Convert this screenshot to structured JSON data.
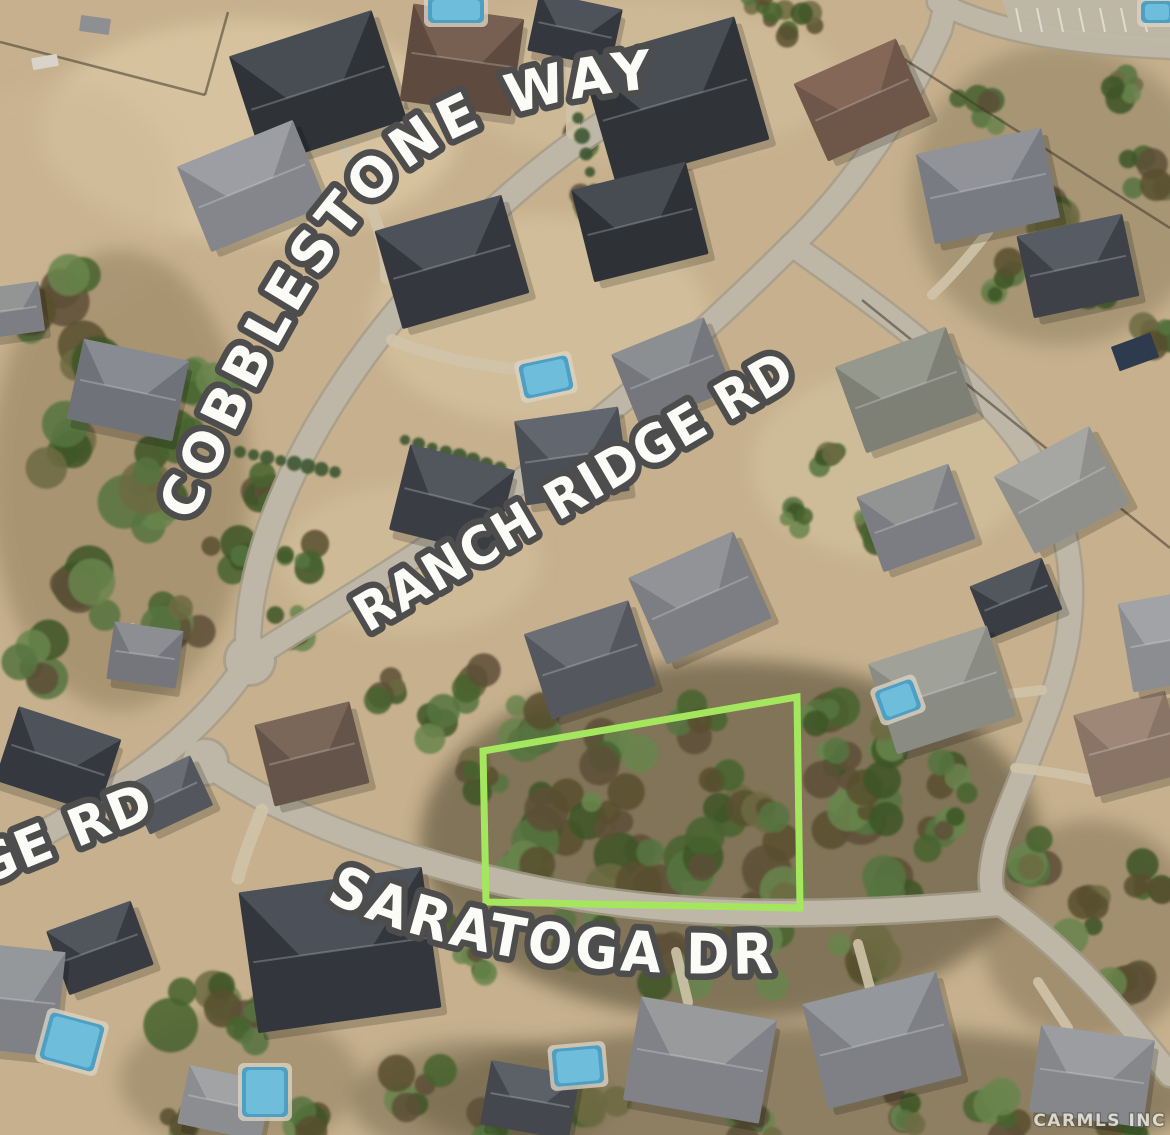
{
  "labels": {
    "cobblestone": "COBBLESTONE WAY",
    "ranch_ridge": "RANCH RIDGE RD",
    "ridge_partial": "GE RD",
    "saratoga": "SARATOGA DR",
    "watermark": "CARMLS INC"
  },
  "map": {
    "type": "aerial-satellite-lot-highlight",
    "lot_outline": {
      "points": "483,751 797,697 800,908 486,902",
      "color": "#a4e75e",
      "stroke_width": 7
    }
  },
  "palette": {
    "dirt_base": "#c6b08d",
    "road": "#beb7a7",
    "road_casing": "#a59d8b",
    "driveway": "#cfc3a8",
    "label_fill": "#fbfbf8",
    "label_outline": "#4d4d4d",
    "pool": "#4d9fc4",
    "pool_inner": "#74c2de",
    "hedge": "#3e5630",
    "fence": "#43392c",
    "tree_colors": [
      "#46632f",
      "#567441",
      "#3c5527",
      "#69854d",
      "#6d6a42",
      "#59502f",
      "#5d4f38"
    ]
  },
  "scene": {
    "patches": [
      [
        250,
        130,
        210,
        110,
        "#dcc9a4",
        0.75
      ],
      [
        540,
        320,
        170,
        105,
        "#d9c6a2",
        0.6
      ],
      [
        890,
        465,
        140,
        95,
        "#d6c5a2",
        0.55
      ],
      [
        410,
        560,
        130,
        75,
        "#d8c5a1",
        0.5
      ],
      [
        640,
        80,
        200,
        80,
        "#d5c2a0",
        0.5
      ],
      [
        60,
        200,
        120,
        120,
        "#cdb795",
        0.5
      ],
      [
        120,
        480,
        130,
        230,
        "#8d7a58",
        0.5
      ],
      [
        730,
        840,
        310,
        180,
        "#5d553c",
        0.65
      ],
      [
        800,
        1100,
        390,
        75,
        "#6a6146",
        0.6
      ],
      [
        1060,
        195,
        150,
        150,
        "#8a7c5c",
        0.5
      ],
      [
        480,
        1100,
        130,
        60,
        "#6f6549",
        0.5
      ],
      [
        1090,
        930,
        110,
        110,
        "#77684c",
        0.45
      ],
      [
        240,
        1080,
        120,
        70,
        "#7c6d50",
        0.4
      ]
    ],
    "roads": [
      {
        "d": "M 655,95 C 560,140 440,250 362,358 C 292,455 250,555 248,640 L 250,660",
        "w": 24
      },
      {
        "d": "M 250,660 C 210,720 150,780 -10,862",
        "w": 24
      },
      {
        "d": "M 205,762 C 290,822 420,868 565,895 C 690,917 820,918 1000,903",
        "w": 24
      },
      {
        "d": "M 1000,903 C 1065,948 1115,1005 1170,1075",
        "w": 22
      },
      {
        "d": "M 252,658 C 340,602 440,545 535,470 C 635,395 725,312 792,245",
        "w": 22
      },
      {
        "d": "M 792,245 C 845,195 900,120 940,30 L 948,-5",
        "w": 22
      },
      {
        "d": "M 792,245 C 870,300 960,365 1015,435 C 1065,500 1078,565 1068,635 C 1058,705 1012,790 996,845 C 989,875 988,893 1000,903",
        "w": 22
      },
      {
        "d": "M 938,2 C 990,30 1065,44 1175,48",
        "w": 20
      }
    ],
    "bulbs": [
      [
        250,
        660,
        24
      ],
      [
        205,
        762,
        22
      ]
    ],
    "parking": {
      "apron": "M 1002,0 L 1170,0 L 1170,42 C 1100,40 1040,30 1008,18 Z",
      "x0": 1016,
      "y0": 8,
      "count": 7,
      "dx": 21,
      "len": 24,
      "tilt": 5
    },
    "driveways": [
      {
        "d": "M 345,150 C 372,205 388,245 386,278",
        "w": 12
      },
      {
        "d": "M 573,0 L 573,132",
        "w": 14
      },
      {
        "d": "M 392,340 C 440,360 495,368 548,372",
        "w": 12
      },
      {
        "d": "M 262,810 C 250,840 242,862 238,878",
        "w": 13
      },
      {
        "d": "M 688,1002 L 676,952",
        "w": 10
      },
      {
        "d": "M 870,988 L 858,944",
        "w": 10
      },
      {
        "d": "M 1068,1028 L 1038,982",
        "w": 10
      },
      {
        "d": "M 132,628 L 152,664",
        "w": 10
      },
      {
        "d": "M 95,788 L 138,802",
        "w": 10
      },
      {
        "d": "M 988,232 C 968,258 950,278 932,295",
        "w": 10
      },
      {
        "d": "M 1000,695 L 1042,690",
        "w": 10
      },
      {
        "d": "M 1100,782 C 1070,775 1040,770 1015,768",
        "w": 10
      }
    ],
    "fences": [
      "M 893,52 L 1170,228",
      "M 862,300 L 1170,548",
      "M 0,42 L 205,95",
      "M 205,95 L 228,12"
    ],
    "hedges": [
      {
        "x1": 240,
        "y1": 452,
        "x2": 335,
        "y2": 472,
        "n": 8
      },
      {
        "x1": 405,
        "y1": 440,
        "x2": 500,
        "y2": 468,
        "n": 8
      },
      {
        "x1": 578,
        "y1": 118,
        "x2": 594,
        "y2": 190,
        "n": 5
      }
    ],
    "houses": [
      [
        318,
        88,
        150,
        115,
        -18,
        "#2f3338",
        "#4b5058"
      ],
      [
        575,
        30,
        85,
        60,
        12,
        "#34383e",
        "#51565e"
      ],
      [
        462,
        60,
        112,
        98,
        8,
        "#5e4a3e",
        "#7a6253"
      ],
      [
        675,
        100,
        160,
        128,
        -16,
        "#303439",
        "#4c5159"
      ],
      [
        862,
        100,
        112,
        85,
        -24,
        "#6e5648",
        "#87695a"
      ],
      [
        988,
        186,
        128,
        92,
        -12,
        "#787b81",
        "#94969b"
      ],
      [
        1078,
        266,
        108,
        84,
        -12,
        "#3e4248",
        "#5a5f67"
      ],
      [
        252,
        186,
        125,
        92,
        -22,
        "#84868b",
        "#9fa1a5"
      ],
      [
        128,
        390,
        108,
        82,
        12,
        "#6f7278",
        "#8b8e93"
      ],
      [
        12,
        310,
        60,
        50,
        -8,
        "#7c7e83",
        "#969896"
      ],
      [
        452,
        262,
        132,
        102,
        -16,
        "#34383e",
        "#50555d"
      ],
      [
        640,
        222,
        118,
        95,
        -14,
        "#2e3237",
        "#4a4f57"
      ],
      [
        672,
        372,
        100,
        78,
        -22,
        "#75777d",
        "#8f9194"
      ],
      [
        906,
        390,
        118,
        92,
        -20,
        "#7e8076",
        "#989a90"
      ],
      [
        1062,
        490,
        108,
        88,
        -28,
        "#8f908c",
        "#a8a9a4"
      ],
      [
        916,
        518,
        98,
        80,
        -20,
        "#7b7d82",
        "#959796"
      ],
      [
        1016,
        598,
        78,
        56,
        -22,
        "#3a3e44",
        "#555a62"
      ],
      [
        572,
        456,
        105,
        85,
        -8,
        "#4a4e55",
        "#656a72"
      ],
      [
        452,
        500,
        108,
        88,
        14,
        "#3a3e44",
        "#555a62"
      ],
      [
        590,
        660,
        110,
        90,
        -18,
        "#54575d",
        "#6e7178"
      ],
      [
        700,
        598,
        115,
        95,
        -24,
        "#7c7e83",
        "#949699"
      ],
      [
        145,
        655,
        70,
        58,
        8,
        "#74767c",
        "#8f9193"
      ],
      [
        58,
        760,
        108,
        78,
        18,
        "#35393f",
        "#51565e"
      ],
      [
        170,
        795,
        70,
        55,
        -25,
        "#53565c",
        "#6d7077"
      ],
      [
        312,
        754,
        98,
        84,
        -14,
        "#64544a",
        "#7d695c"
      ],
      [
        340,
        950,
        185,
        142,
        -8,
        "#33373d",
        "#4f545c"
      ],
      [
        100,
        948,
        90,
        68,
        -20,
        "#383c42",
        "#54595f"
      ],
      [
        18,
        1000,
        85,
        105,
        6,
        "#7f8186",
        "#989a9d"
      ],
      [
        225,
        1103,
        85,
        60,
        12,
        "#8b8d90",
        "#a3a5a7"
      ],
      [
        530,
        1100,
        90,
        65,
        10,
        "#44484e",
        "#5f646c"
      ],
      [
        700,
        1060,
        138,
        105,
        10,
        "#808287",
        "#9a9c9f"
      ],
      [
        882,
        1040,
        138,
        108,
        -14,
        "#7e8085",
        "#97999d"
      ],
      [
        1092,
        1076,
        115,
        88,
        8,
        "#85878b",
        "#9da0a2"
      ],
      [
        942,
        690,
        125,
        95,
        -18,
        "#8a8c84",
        "#a2a49c"
      ],
      [
        1130,
        744,
        95,
        85,
        -15,
        "#8a7465",
        "#a08a78"
      ],
      [
        1160,
        642,
        70,
        90,
        -10,
        "#8b8d91",
        "#a3a5a8"
      ]
    ],
    "pools": [
      [
        456,
        10,
        56,
        26,
        0
      ],
      [
        546,
        377,
        50,
        35,
        -12
      ],
      [
        898,
        700,
        40,
        32,
        -20
      ],
      [
        72,
        1042,
        56,
        48,
        15
      ],
      [
        265,
        1092,
        46,
        50,
        0
      ],
      [
        1157,
        12,
        32,
        22,
        0
      ],
      [
        578,
        1066,
        50,
        38,
        -5
      ]
    ],
    "trees": [
      [
        55,
        300,
        38
      ],
      [
        105,
        375,
        42
      ],
      [
        68,
        448,
        38
      ],
      [
        140,
        515,
        42
      ],
      [
        92,
        588,
        38
      ],
      [
        178,
        618,
        32
      ],
      [
        40,
        658,
        32
      ],
      [
        228,
        558,
        28
      ],
      [
        168,
        448,
        32
      ],
      [
        208,
        378,
        28
      ],
      [
        255,
        490,
        24
      ],
      [
        300,
        560,
        22
      ],
      [
        290,
        625,
        20
      ],
      [
        582,
        148,
        20
      ],
      [
        590,
        200,
        16
      ],
      [
        800,
        25,
        22
      ],
      [
        760,
        8,
        18
      ],
      [
        975,
        115,
        28
      ],
      [
        1038,
        218,
        32
      ],
      [
        1098,
        278,
        28
      ],
      [
        1148,
        178,
        28
      ],
      [
        1000,
        278,
        22
      ],
      [
        1128,
        88,
        22
      ],
      [
        958,
        195,
        24
      ],
      [
        1160,
        330,
        24
      ],
      [
        836,
        458,
        22
      ],
      [
        872,
        532,
        22
      ],
      [
        800,
        520,
        18
      ],
      [
        470,
        688,
        26
      ],
      [
        522,
        728,
        30
      ],
      [
        482,
        778,
        26
      ],
      [
        560,
        818,
        36
      ],
      [
        638,
        868,
        40
      ],
      [
        718,
        798,
        36
      ],
      [
        778,
        878,
        40
      ],
      [
        848,
        818,
        36
      ],
      [
        898,
        878,
        32
      ],
      [
        678,
        958,
        36
      ],
      [
        582,
        938,
        32
      ],
      [
        758,
        958,
        36
      ],
      [
        858,
        948,
        32
      ],
      [
        938,
        828,
        28
      ],
      [
        618,
        758,
        30
      ],
      [
        698,
        718,
        26
      ],
      [
        818,
        718,
        30
      ],
      [
        898,
        738,
        26
      ],
      [
        958,
        778,
        26
      ],
      [
        528,
        868,
        30
      ],
      [
        610,
        810,
        30
      ],
      [
        690,
        860,
        34
      ],
      [
        760,
        820,
        30
      ],
      [
        830,
        760,
        28
      ],
      [
        880,
        800,
        28
      ],
      [
        1028,
        858,
        30
      ],
      [
        1088,
        918,
        28
      ],
      [
        1118,
        968,
        30
      ],
      [
        1150,
        880,
        24
      ],
      [
        418,
        1088,
        30
      ],
      [
        498,
        1118,
        30
      ],
      [
        598,
        1112,
        26
      ],
      [
        758,
        1118,
        30
      ],
      [
        898,
        1112,
        26
      ],
      [
        998,
        1118,
        30
      ],
      [
        1118,
        1118,
        26
      ],
      [
        298,
        1118,
        26
      ],
      [
        178,
        1128,
        22
      ],
      [
        200,
        1000,
        40
      ],
      [
        255,
        1032,
        28
      ],
      [
        388,
        688,
        22
      ],
      [
        432,
        728,
        24
      ],
      [
        470,
        960,
        22
      ],
      [
        430,
        920,
        20
      ]
    ],
    "sheds": [
      [
        45,
        62,
        26,
        12,
        -10,
        "#d8d4cb"
      ],
      [
        95,
        25,
        30,
        16,
        8,
        "#8d8f92"
      ],
      [
        1135,
        352,
        42,
        26,
        -20,
        "#2e3b4e"
      ]
    ]
  }
}
